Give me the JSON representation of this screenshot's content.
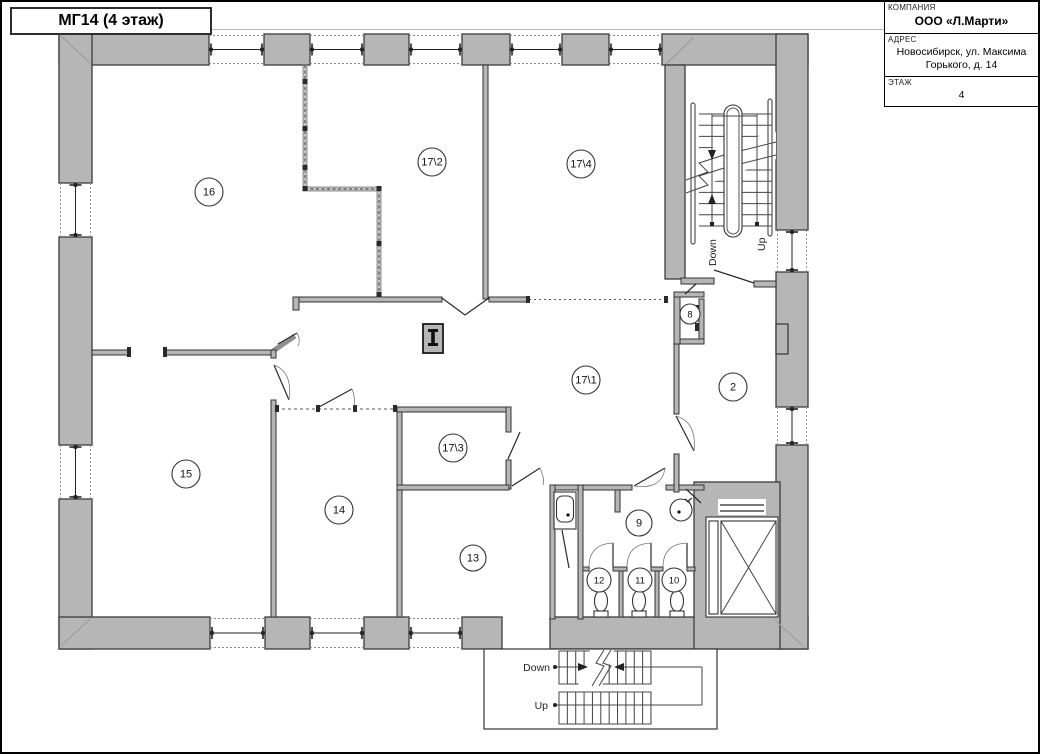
{
  "header": {
    "title": "МГ14 (4 этаж)"
  },
  "title_block": {
    "company_label": "КОМПАНИЯ",
    "company_value": "ООО «Л.Марти»",
    "address_label": "АДРЕС",
    "address_line1": "Новосибирск, ул. Максима",
    "address_line2": "Горького, д. 14",
    "floor_label": "ЭТАЖ",
    "floor_value": "4"
  },
  "rooms": [
    {
      "label": "16"
    },
    {
      "label": "17\\2"
    },
    {
      "label": "17\\4"
    },
    {
      "label": "17\\1"
    },
    {
      "label": "17\\3"
    },
    {
      "label": "2"
    },
    {
      "label": "8"
    },
    {
      "label": "15"
    },
    {
      "label": "14"
    },
    {
      "label": "13"
    },
    {
      "label": "9"
    },
    {
      "label": "12"
    },
    {
      "label": "11"
    },
    {
      "label": "10"
    }
  ],
  "stairwells": {
    "main": {
      "down_label": "Down",
      "up_label": "Up"
    },
    "back": {
      "down_label": "Down",
      "up_label": "Up"
    }
  },
  "colors": {
    "wall_fill": "#b6b6b6",
    "wall_stroke": "#3c3c3c",
    "line": "#2a2a2a"
  }
}
